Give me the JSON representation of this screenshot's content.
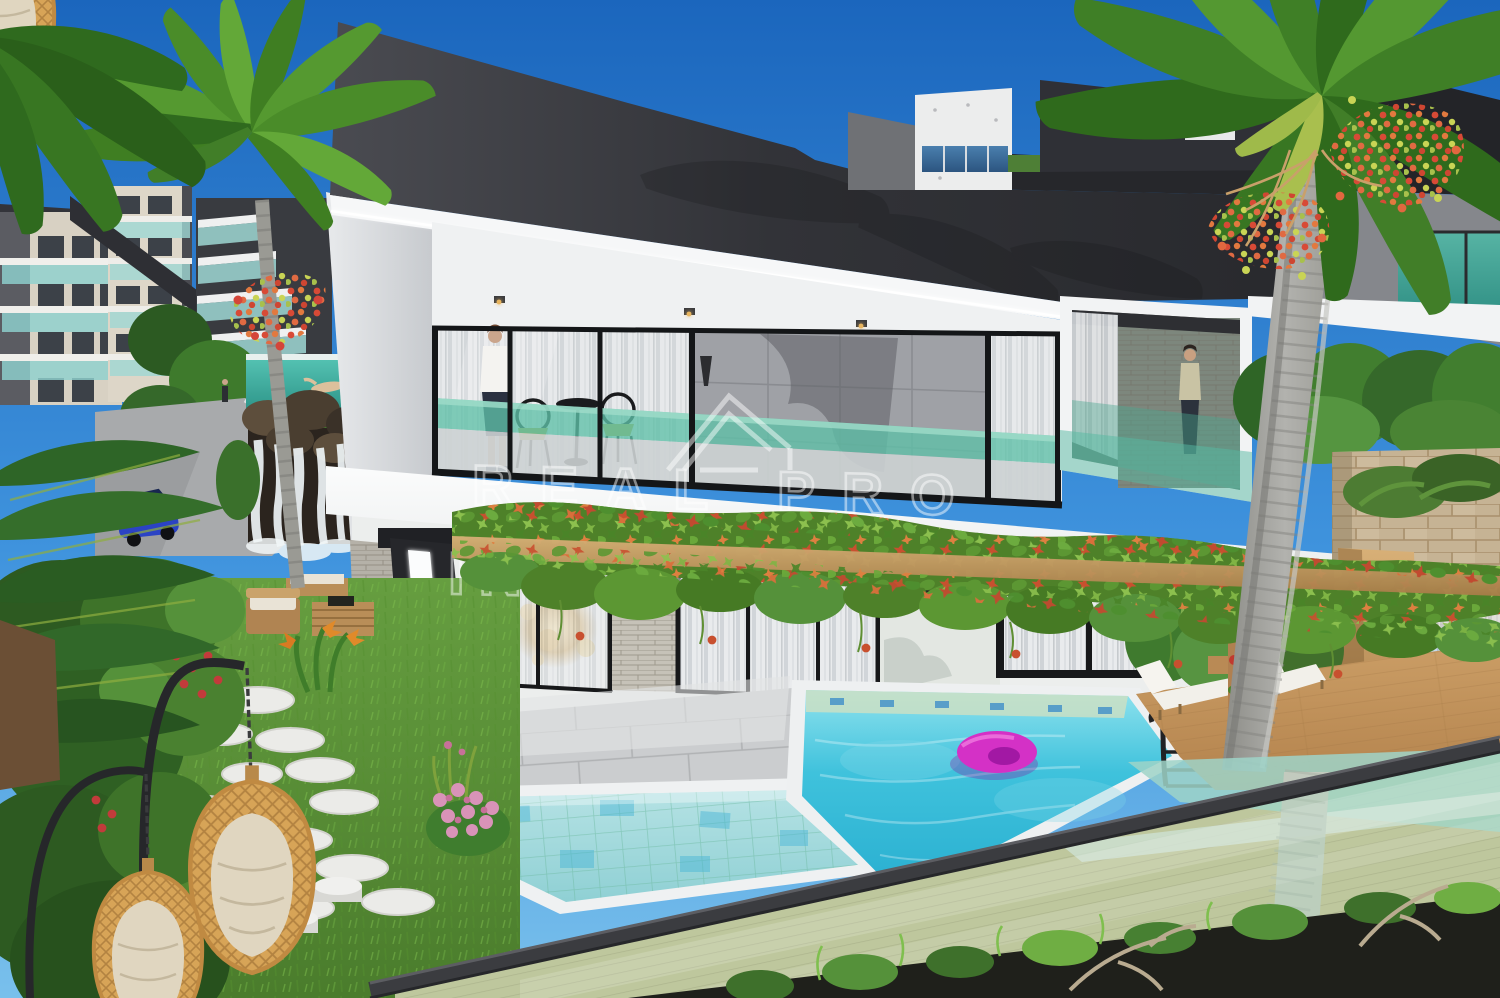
{
  "meta": {
    "type": "3d-architectural-exterior-rendering",
    "subject": "Modern two-storey villa with infinity pool, vine-covered pergola and tropical garden",
    "width_px": 1500,
    "height_px": 998
  },
  "watermark": {
    "logo": "house-roof-outline",
    "line1": "REAL PRO",
    "line2": "INVESTMENTS",
    "style": "semi-transparent white outline capitals, centered"
  },
  "palette": {
    "sky_top": "#1b66bd",
    "sky_bottom": "#79c0ec",
    "roof_dark": "#2b2c30",
    "soffit_white": "#f6f7f8",
    "fascia_white": "#f7f8f9",
    "balcony_glass_teal": "#5fc0a8",
    "curtain_glass": "#e9ebed",
    "pergola_wood": "#c79a5f",
    "vine_green": "#5c9733",
    "vine_red": "#c8502f",
    "pool_water": "#3fc2dc",
    "kids_pool_water": "#9fd6da",
    "pool_coping": "#eef0f1",
    "float_pink": "#d431c6",
    "deck_wood": "#c69a63",
    "grass_green": "#5f943a",
    "stone_wall_tan": "#c6b394",
    "palm_trunk_gray": "#a3a39f",
    "palm_frond_green": "#549831",
    "palm_berries_red": "#d84a36",
    "egg_chair_rattan": "#d7a457",
    "car_blue": "#2b43c4",
    "fence_rail_dark": "#3b3c40",
    "interior_glow_amber": "#e8c478"
  },
  "scene_inventory": {
    "background": [
      "blue sky",
      "apartment buildings with teal glass balconies",
      "tiered balcony building",
      "modern white and dark building",
      "green trees"
    ],
    "villa": [
      "dark angular overhanging roof with LED soffit",
      "upper glass balcony with standing woman",
      "black bistro table and two chairs",
      "right balcony with second woman",
      "vine-covered wooden pergola",
      "ground floor glass doors with curtains and warm interior light",
      "LED-lit angled entry pillar",
      "stone cladding"
    ],
    "grounds": [
      "main turquoise pool",
      "lower kids pool",
      "pink donut pool float",
      "black pool ladder",
      "wooden sun deck",
      "two white sun loungers",
      "frameless glass pool fence with dark handrail",
      "white stepping stones on lawn",
      "two hanging rattan egg chairs",
      "wooden garden sofa set",
      "pink flower bush",
      "waterfall over rocks",
      "elevated glass pool with swimmer",
      "blue parked car",
      "tall palm trees with red berry clusters"
    ]
  }
}
